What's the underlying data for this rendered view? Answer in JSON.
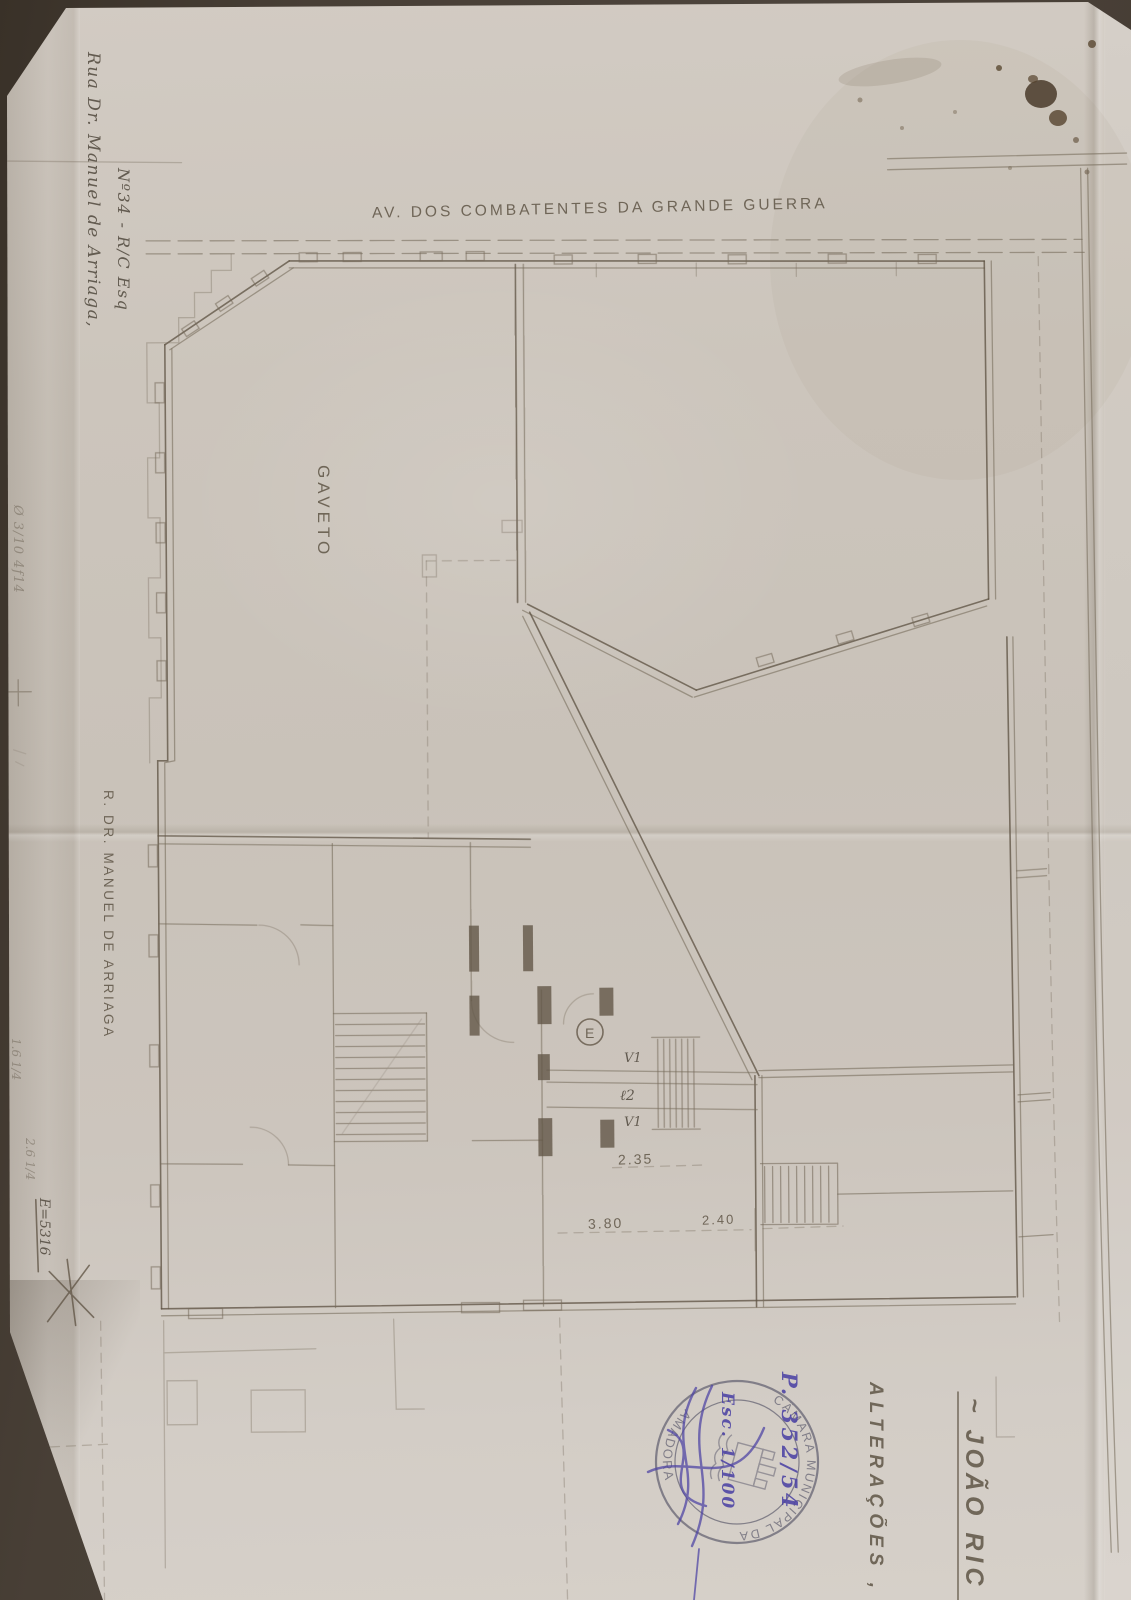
{
  "scan": {
    "backdrop_color": "#463d33",
    "paper_color": "#ccc5bc",
    "pencil_color": "#6e6455",
    "blue_ink_color": "#4c42a4",
    "stamp_ink_color": "#6f6d7b"
  },
  "notes": {
    "address_line1": "Rua Dr. Manuel de Arriaga,",
    "address_line2": "Nº34 - R/C Esq",
    "margin_note": "Ø 3/10 4f14",
    "grade_note_1": "1.6 1/4",
    "grade_note_2": "2.6 1/4",
    "ref_note": "E=5316"
  },
  "plan": {
    "street_top_label": "AV. DOS COMBATENTES DA GRANDE GUERRA",
    "corner_label": "GAVETO",
    "street_left_label": "R. DR. MANUEL DE ARRIAGA",
    "dim_1": "2.35",
    "dim_2": "3.80",
    "dim_3": "2.40",
    "entrance_label": "E",
    "window_label_upper": "V1",
    "level_label": "ℓ2",
    "window_label_lower": "V1"
  },
  "title_block": {
    "owner_name": "~ JOÃO RIC",
    "project_type": "ALTERAÇÕES ,"
  },
  "stamp": {
    "arc_top": "CÂMARA MUNICIPAL DA",
    "arc_bottom": "AMADORA",
    "process_number": "P. 352/54",
    "scale_note": "Esc. 1/100"
  }
}
